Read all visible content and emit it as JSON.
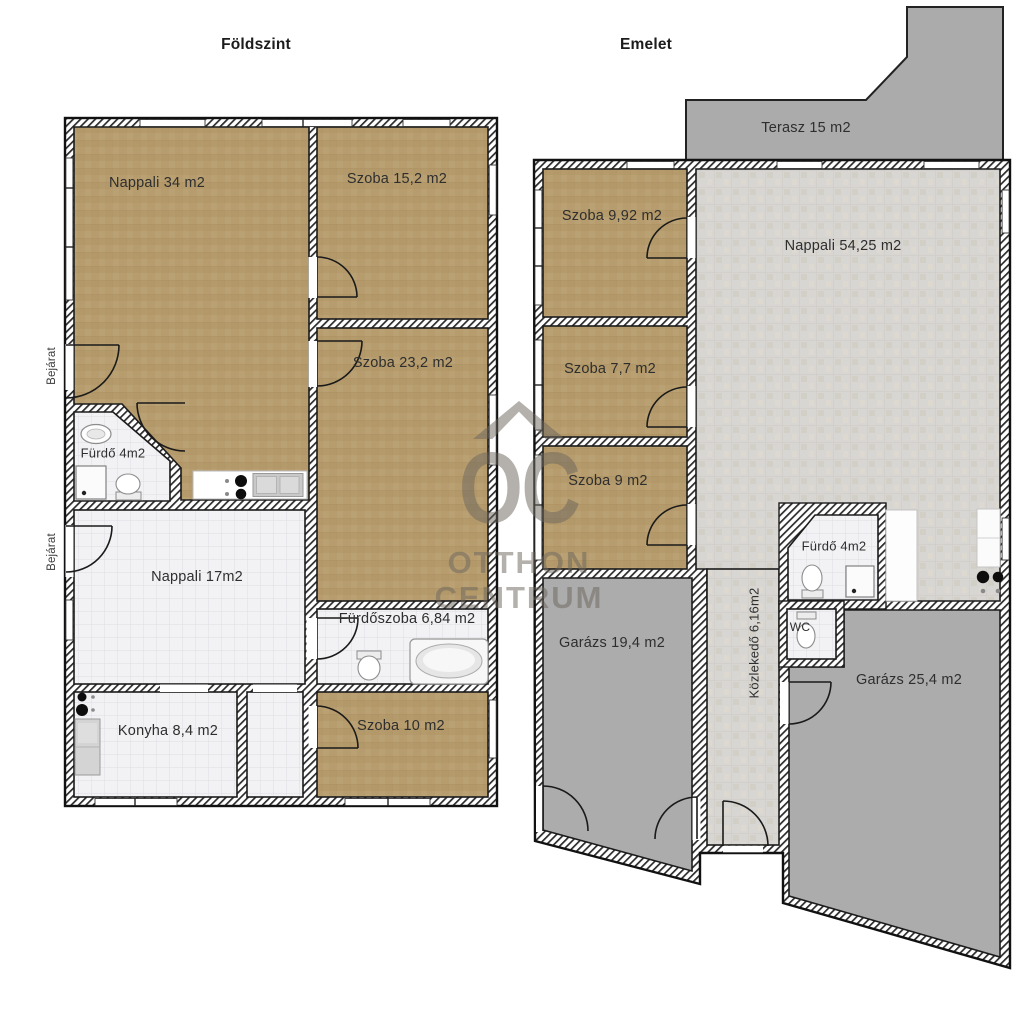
{
  "watermark": {
    "oc": "OC",
    "line1": "OTTHON",
    "line2": "CENTRUM"
  },
  "ground_floor": {
    "title": "Földszint",
    "entrance_top": "Bejárat",
    "entrance_bottom": "Bejárat",
    "rooms": {
      "nappali34": "Nappali 34 m2",
      "szoba152": "Szoba 15,2 m2",
      "szoba232": "Szoba 23,2 m2",
      "furdo": "Fürdő 4m2",
      "nappali17": "Nappali 17m2",
      "furdoszoba": "Fürdőszoba 6,84 m2",
      "konyha": "Konyha 8,4 m2",
      "szoba10": "Szoba 10 m2"
    }
  },
  "upper_floor": {
    "title": "Emelet",
    "rooms": {
      "terasz": "Terasz 15 m2",
      "szoba992": "Szoba 9,92 m2",
      "nappali5425": "Nappali 54,25 m2",
      "szoba77": "Szoba 7,7 m2",
      "szoba9": "Szoba 9 m2",
      "furdo": "Fürdő 4m2",
      "wc": "WC",
      "garaz194": "Garázs 19,4 m2",
      "kozlekedo": "Közlekedő 6,16m2",
      "garaz254": "Garázs 25,4 m2"
    }
  },
  "colors": {
    "room_brown": "#b79c6e",
    "tile_white": "#f2f2f4",
    "tile_gray": "#d8d6d3",
    "garage_gray": "#acacac",
    "terrace_gray": "#ababab",
    "wall_line": "#161616",
    "label_text": "#2e2e2e",
    "watermark_gray": "rgba(106,100,92,0.5)"
  }
}
